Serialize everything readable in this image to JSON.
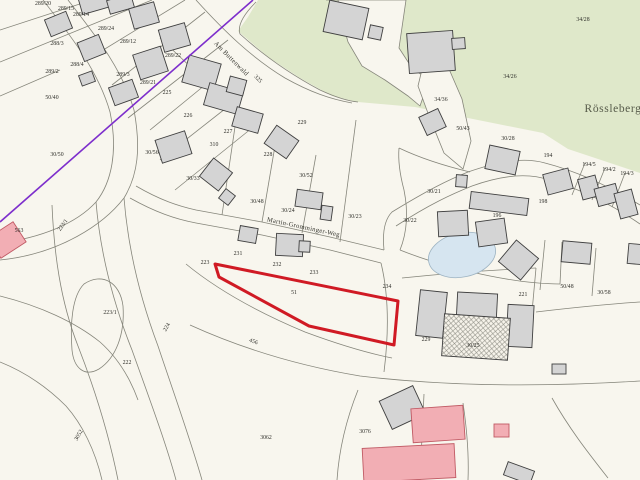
{
  "map": {
    "colors": {
      "background": "#f8f6ee",
      "parcel_line": "#85857a",
      "green": "#dfe8ca",
      "building_fill": "#d4d4d4",
      "building_stroke": "#3f3f3f",
      "pink_fill": "#f2aeb4",
      "pink_stroke": "#c05a64",
      "pond_fill": "#d6e5f0",
      "pond_stroke": "#9db3c2",
      "highlight": "#d01a24",
      "purple": "#7d2ecc",
      "label": "#2f2f2a"
    },
    "green_areas": [
      "258,0 640,0 640,173 568,149 543,133 463,117 415,107 358,102 332,96 300,78 268,57 238,31 248,17"
    ],
    "cream_overlays": [
      "326,0 406,0 399,48 412,68 429,80 420,106 408,96 385,80 362,66 348,42 342,20 338,0",
      "425,57 449,69 462,99 471,141 463,169 444,153 429,116 418,86"
    ],
    "boundary_lines": [
      "M43,0 C70,35 98,70 110,112 C118,150 112,182 96,202 C76,224 40,238 0,243",
      "M68,0 C95,35 122,68 134,110 C141,148 138,175 124,198 C104,224 60,254 0,260",
      "M96,202 C100,250 112,300 132,350 C148,395 165,440 176,480",
      "M124,198 C128,248 140,298 158,346 C172,388 190,438 202,480",
      "M136,186 C160,200 178,206 196,210 L262,222 L330,237 L384,250",
      "M130,198 C155,212 175,219 196,223 L262,235 L330,250 L381,263",
      "M384,250 C382,230 386,218 392,212 C428,190 448,180 468,172 C505,159 528,158 545,163 C580,172 612,188 640,205",
      "M396,226 C430,204 452,194 472,186 C508,173 532,174 549,180 C584,190 614,206 640,224",
      "M381,263 C390,300 388,340 384,372",
      "M190,325 C245,350 300,366 360,376 C460,388 560,386 640,381",
      "M358,390 C346,420 339,450 337,480",
      "M463,403 C467,430 469,456 468,480",
      "M186,264 C220,292 262,314 305,332 C340,345 372,354 392,358",
      "M0,296 C40,306 75,322 100,342 C118,358 130,378 138,400",
      "M52,205 C54,252 60,300 78,346 C92,382 108,430 118,480",
      "M84,284 C102,272 120,282 123,306 C125,334 116,358 99,369 C85,377 74,369 72,350 C70,324 72,296 84,284 Z",
      "M0,30 L92,0",
      "M0,62 L152,0",
      "M95,55 L185,0",
      "M112,85 L205,12",
      "M128,118 L228,40",
      "M160,38 L196,72",
      "M60,70 L0,96",
      "M196,0 C225,32 252,58 285,78 C310,92 330,99 352,103",
      "M256,2 C240,18 238,28 240,34 C262,54 290,74 320,90 C335,97 348,101 358,102",
      "M150,130 L205,85",
      "M160,160 L230,105",
      "M175,190 L252,128",
      "M236,120 L222,215",
      "M276,140 L262,222",
      "M316,155 L302,233",
      "M356,120 L340,242",
      "M400,250 C408,230 408,210 404,190 C400,175 398,160 399,148",
      "M399,148 C420,158 445,166 470,172",
      "M400,250 C430,262 460,270 490,276 C520,282 545,284 560,284",
      "M560,284 L562,242",
      "M540,290 L545,240",
      "M592,296 L596,248",
      "M536,312 C570,308 610,304 640,302",
      "M585,163 L572,195",
      "M605,168 L592,200",
      "M625,173 L612,207",
      "M402,278 C440,274 490,270 536,268",
      "M536,268 L532,312",
      "M424,394 L420,480",
      "M552,398 C570,430 590,455 608,478",
      "M0,362 C25,372 48,388 66,406 C82,424 95,450 102,480",
      "M215,264 L398,301"
    ],
    "pond": {
      "cx": 462,
      "cy": 255,
      "rx": 34,
      "ry": 22,
      "rot": -12
    },
    "red_parcel": {
      "points": "215,264 398,301 394,345 309,326 219,277",
      "label": "51",
      "lx": 294,
      "ly": 294
    },
    "purple_line": {
      "x1": 253,
      "y1": 0,
      "x2": 0,
      "y2": 222
    },
    "buildings": {
      "gray": [
        [
          80,
          -5,
          28,
          16,
          -16
        ],
        [
          108,
          -3,
          25,
          14,
          -16
        ],
        [
          131,
          5,
          26,
          21,
          -16
        ],
        [
          161,
          26,
          27,
          23,
          -16
        ],
        [
          47,
          15,
          23,
          18,
          -22
        ],
        [
          80,
          38,
          23,
          20,
          -22
        ],
        [
          136,
          50,
          29,
          26,
          -18
        ],
        [
          111,
          83,
          25,
          19,
          -20
        ],
        [
          80,
          73,
          14,
          11,
          -20
        ],
        [
          158,
          135,
          31,
          24,
          -18
        ],
        [
          185,
          59,
          33,
          28,
          16
        ],
        [
          206,
          87,
          35,
          23,
          16
        ],
        [
          234,
          110,
          27,
          20,
          16
        ],
        [
          204,
          163,
          24,
          23,
          38
        ],
        [
          221,
          191,
          12,
          12,
          38
        ],
        [
          268,
          131,
          27,
          22,
          35
        ],
        [
          228,
          78,
          17,
          16,
          15
        ],
        [
          326,
          4,
          40,
          32,
          12
        ],
        [
          369,
          26,
          13,
          13,
          12
        ],
        [
          408,
          32,
          46,
          40,
          -4
        ],
        [
          452,
          38,
          13,
          11,
          -4
        ],
        [
          422,
          112,
          21,
          20,
          -25
        ],
        [
          456,
          175,
          11,
          12,
          4
        ],
        [
          487,
          148,
          31,
          24,
          12
        ],
        [
          470,
          195,
          58,
          17,
          7
        ],
        [
          438,
          211,
          30,
          25,
          -3
        ],
        [
          477,
          220,
          29,
          25,
          -8
        ],
        [
          504,
          246,
          29,
          28,
          40
        ],
        [
          545,
          171,
          26,
          21,
          -15
        ],
        [
          580,
          177,
          18,
          21,
          -15
        ],
        [
          596,
          186,
          22,
          18,
          -15
        ],
        [
          617,
          191,
          18,
          26,
          -15
        ],
        [
          562,
          242,
          29,
          21,
          5
        ],
        [
          628,
          244,
          14,
          20,
          5
        ],
        [
          418,
          291,
          27,
          46,
          6
        ],
        [
          457,
          293,
          40,
          25,
          3
        ],
        [
          507,
          305,
          26,
          42,
          3
        ],
        [
          552,
          364,
          14,
          10,
          0
        ],
        [
          384,
          392,
          37,
          31,
          -25
        ],
        [
          505,
          466,
          28,
          14,
          20
        ],
        [
          296,
          191,
          26,
          17,
          8
        ],
        [
          321,
          206,
          11,
          14,
          8
        ],
        [
          239,
          227,
          18,
          15,
          10
        ],
        [
          276,
          234,
          27,
          22,
          3
        ],
        [
          299,
          241,
          11,
          11,
          3
        ]
      ],
      "pink": [
        [
          -8,
          228,
          30,
          24,
          -33
        ],
        [
          412,
          407,
          52,
          34,
          -4
        ],
        [
          363,
          446,
          92,
          34,
          -3
        ],
        [
          494,
          424,
          15,
          13,
          0
        ]
      ],
      "hatch": [
        [
          443,
          316,
          66,
          42,
          4
        ]
      ]
    },
    "parcel_labels": [
      {
        "t": "289/20",
        "x": 43,
        "y": 5
      },
      {
        "t": "289/15",
        "x": 66,
        "y": 10
      },
      {
        "t": "289/14",
        "x": 81,
        "y": 16
      },
      {
        "t": "289/24",
        "x": 106,
        "y": 30
      },
      {
        "t": "289/12",
        "x": 128,
        "y": 43
      },
      {
        "t": "288/3",
        "x": 57,
        "y": 45
      },
      {
        "t": "288/4",
        "x": 77,
        "y": 66
      },
      {
        "t": "289/2",
        "x": 52,
        "y": 73
      },
      {
        "t": "289/3",
        "x": 123,
        "y": 76
      },
      {
        "t": "289/22",
        "x": 173,
        "y": 57
      },
      {
        "t": "289/21",
        "x": 148,
        "y": 84
      },
      {
        "t": "225",
        "x": 167,
        "y": 94
      },
      {
        "t": "50/40",
        "x": 52,
        "y": 99
      },
      {
        "t": "30/50",
        "x": 57,
        "y": 156
      },
      {
        "t": "30/56",
        "x": 152,
        "y": 154
      },
      {
        "t": "310",
        "x": 214,
        "y": 146
      },
      {
        "t": "226",
        "x": 188,
        "y": 117
      },
      {
        "t": "227",
        "x": 228,
        "y": 133
      },
      {
        "t": "228",
        "x": 268,
        "y": 156
      },
      {
        "t": "229",
        "x": 302,
        "y": 124
      },
      {
        "t": "30/52",
        "x": 306,
        "y": 177
      },
      {
        "t": "30/33",
        "x": 193,
        "y": 180
      },
      {
        "t": "30/48",
        "x": 257,
        "y": 203
      },
      {
        "t": "30/24",
        "x": 288,
        "y": 212
      },
      {
        "t": "30/23",
        "x": 355,
        "y": 218
      },
      {
        "t": "30/21",
        "x": 434,
        "y": 193
      },
      {
        "t": "30/22",
        "x": 410,
        "y": 222
      },
      {
        "t": "196",
        "x": 497,
        "y": 217
      },
      {
        "t": "198",
        "x": 543,
        "y": 203
      },
      {
        "t": "194",
        "x": 548,
        "y": 157
      },
      {
        "t": "194/5",
        "x": 589,
        "y": 166
      },
      {
        "t": "194/2",
        "x": 609,
        "y": 171
      },
      {
        "t": "194/3",
        "x": 627,
        "y": 175
      },
      {
        "t": "34/28",
        "x": 583,
        "y": 21
      },
      {
        "t": "34/26",
        "x": 510,
        "y": 78
      },
      {
        "t": "34/36",
        "x": 441,
        "y": 101
      },
      {
        "t": "50/43",
        "x": 463,
        "y": 130
      },
      {
        "t": "30/28",
        "x": 508,
        "y": 140
      },
      {
        "t": "231",
        "x": 238,
        "y": 255
      },
      {
        "t": "232",
        "x": 277,
        "y": 266
      },
      {
        "t": "233",
        "x": 314,
        "y": 274
      },
      {
        "t": "234",
        "x": 387,
        "y": 288
      },
      {
        "t": "223",
        "x": 205,
        "y": 264
      },
      {
        "t": "223/1",
        "x": 110,
        "y": 314
      },
      {
        "t": "222",
        "x": 127,
        "y": 364
      },
      {
        "t": "229",
        "x": 426,
        "y": 341
      },
      {
        "t": "30/25",
        "x": 473,
        "y": 347
      },
      {
        "t": "221",
        "x": 523,
        "y": 296
      },
      {
        "t": "50/48",
        "x": 567,
        "y": 288
      },
      {
        "t": "30/58",
        "x": 604,
        "y": 294
      },
      {
        "t": "3062",
        "x": 266,
        "y": 439
      },
      {
        "t": "3076",
        "x": 365,
        "y": 433
      },
      {
        "t": "563",
        "x": 19,
        "y": 232
      },
      {
        "t": "325",
        "x": 257,
        "y": 80,
        "r": 45
      },
      {
        "t": "223/1",
        "x": 64,
        "y": 226,
        "r": -55
      },
      {
        "t": "224",
        "x": 168,
        "y": 328,
        "r": -60
      },
      {
        "t": "456",
        "x": 253,
        "y": 343,
        "r": 20
      },
      {
        "t": "3052",
        "x": 80,
        "y": 436,
        "r": -60
      }
    ],
    "street_labels": [
      {
        "t": "Am Buttenwald",
        "x": 230,
        "y": 60,
        "r": 45
      },
      {
        "t": "Martin-Gromminger-Weg",
        "x": 303,
        "y": 229,
        "r": 12
      }
    ],
    "area_label": {
      "t": "Rössleberg",
      "x": 613,
      "y": 112
    }
  }
}
